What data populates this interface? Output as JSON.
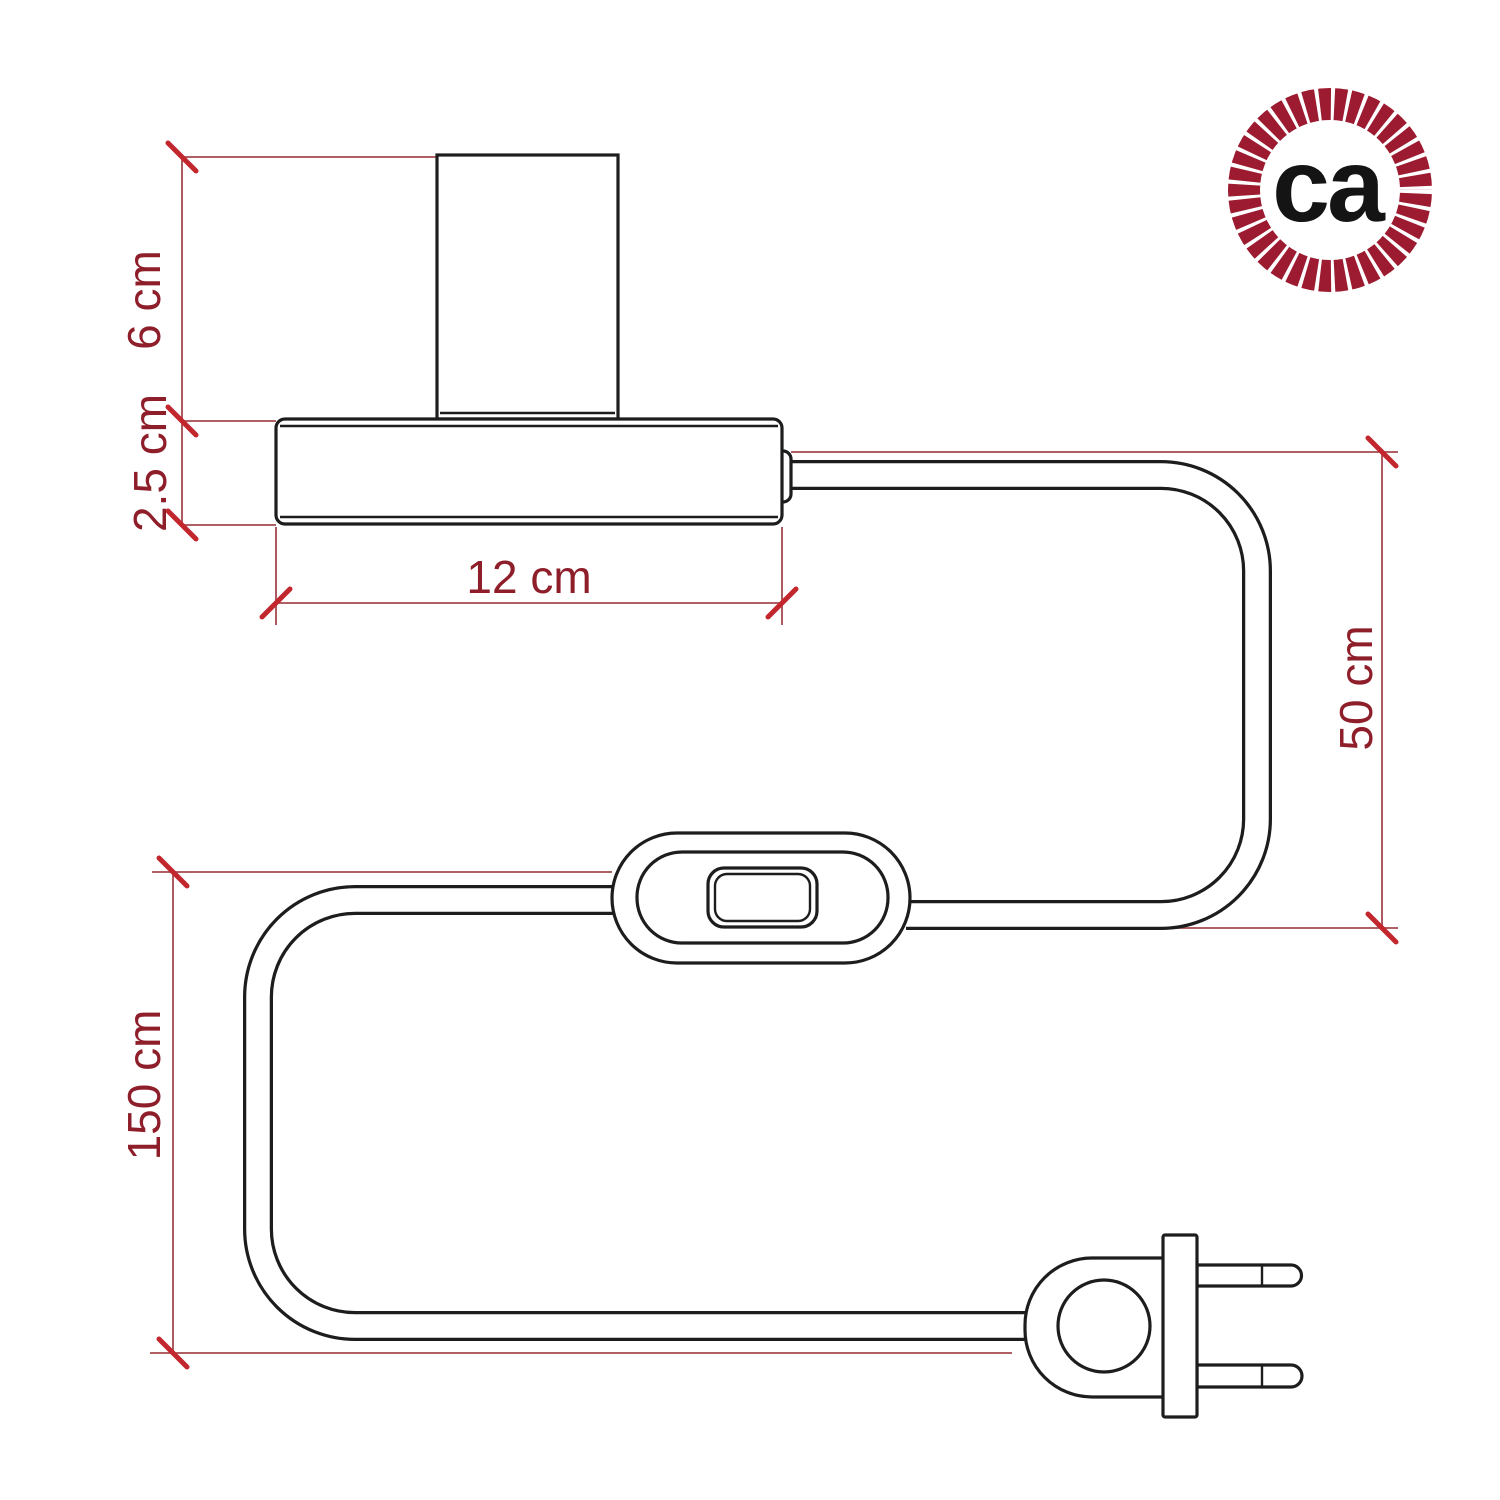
{
  "diagram": {
    "type": "product-dimension-drawing",
    "subject": "table lamp with cylindrical lamp holder, base, inline switch and two-prong plug",
    "parts": [
      "lamp-holder",
      "base",
      "cable",
      "inline-switch",
      "two-prong-plug"
    ]
  },
  "dimensions": [
    {
      "label": "6 cm",
      "measures": "lamp holder height"
    },
    {
      "label": "2.5 cm",
      "measures": "base height"
    },
    {
      "label": "12 cm",
      "measures": "base width"
    },
    {
      "label": "50 cm",
      "measures": "cable length from base to switch"
    },
    {
      "label": "150 cm",
      "measures": "cable length from switch to plug"
    }
  ],
  "logo": {
    "text": "ca"
  },
  "colors": {
    "line": "#1d1d1d",
    "dim": "#a34a4e",
    "tick": "#c1272d",
    "text": "#8e1f2a",
    "ring": "#9c1b30",
    "logoText": "#141414",
    "bg": "#ffffff"
  }
}
